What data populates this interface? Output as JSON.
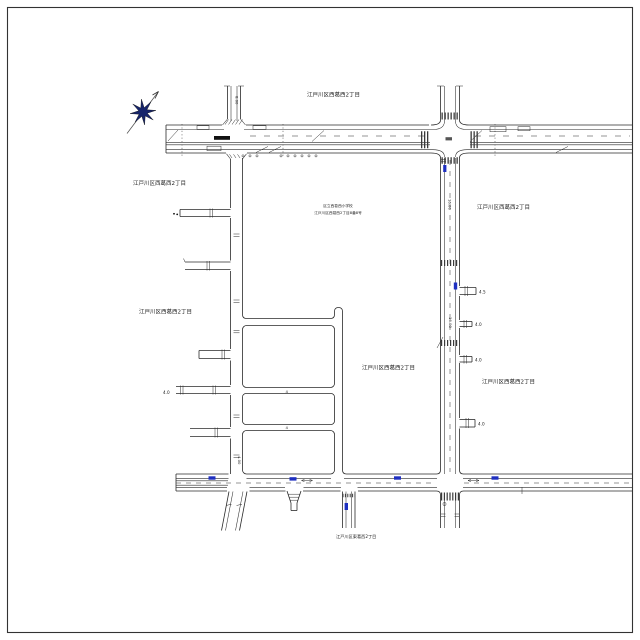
{
  "page": {
    "background": "#ffffff",
    "border_color": "#333333",
    "line_color": "#2a2a2a",
    "accent_blue": "#1e2fc0",
    "compass_fill": "#16246b"
  },
  "labels": {
    "district": [
      {
        "id": "north",
        "text": "江戸川区西葛西2丁目"
      },
      {
        "id": "west-upper",
        "text": "江戸川区西葛西2丁目"
      },
      {
        "id": "west-middle",
        "text": "江戸川区西葛西2丁目"
      },
      {
        "id": "center-east",
        "text": "江戸川区西葛西2丁目"
      },
      {
        "id": "east-upper",
        "text": "江戸川区西葛西2丁目"
      },
      {
        "id": "east-lower",
        "text": "江戸川区西葛西2丁目"
      },
      {
        "id": "south",
        "text": "江戸川区東葛西2丁目"
      }
    ],
    "school": {
      "name": "区立西葛西小学校",
      "address": "江戸川区西葛西2丁目8番8号"
    },
    "width_notes": [
      "4.5",
      "4.0",
      "4.0",
      "4.0",
      "4.0"
    ],
    "road_notes": [
      "8.00",
      "16.00",
      "16.00",
      "4.00"
    ],
    "grid_notes": [
      "4",
      "4"
    ]
  }
}
